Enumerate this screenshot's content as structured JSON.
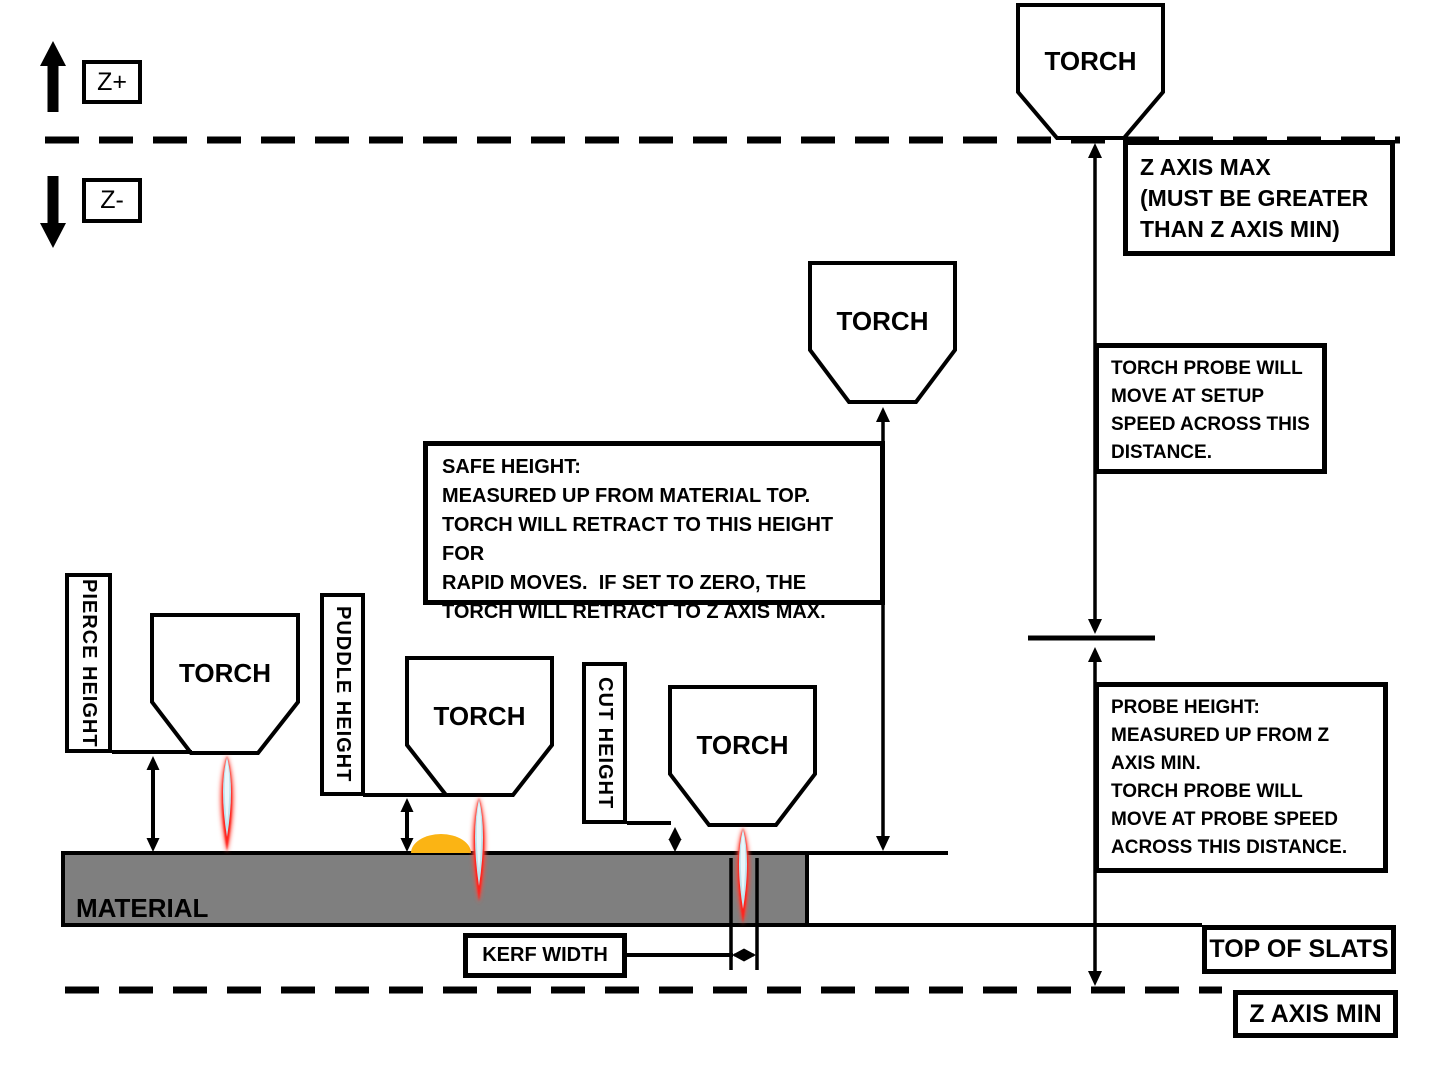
{
  "diagram": {
    "axis": {
      "z_plus": "Z+",
      "z_minus": "Z-"
    },
    "torches": [
      {
        "role": "torch-at-z-axis-max",
        "label": "TORCH"
      },
      {
        "role": "torch-at-safe-height",
        "label": "TORCH"
      },
      {
        "role": "torch-at-pierce-height",
        "label": "TORCH"
      },
      {
        "role": "torch-at-puddle-height",
        "label": "TORCH"
      },
      {
        "role": "torch-at-cut-height",
        "label": "TORCH"
      }
    ],
    "callouts": {
      "z_axis_max": "Z AXIS MAX\n(MUST BE GREATER\nTHAN Z AXIS MIN)",
      "setup_speed": "TORCH PROBE WILL\nMOVE AT SETUP\nSPEED ACROSS THIS\nDISTANCE.",
      "probe_height": "PROBE HEIGHT:\nMEASURED UP FROM Z\nAXIS MIN.\nTORCH PROBE WILL\nMOVE AT PROBE SPEED\nACROSS THIS DISTANCE.",
      "safe_height": "SAFE HEIGHT:\nMEASURED UP FROM MATERIAL TOP.\nTORCH WILL RETRACT TO THIS HEIGHT FOR\nRAPID MOVES.  IF SET TO ZERO, THE\nTORCH WILL RETRACT TO Z AXIS MAX.",
      "kerf_width": "KERF WIDTH",
      "top_of_slats": "TOP OF SLATS",
      "z_axis_min": "Z AXIS MIN"
    },
    "height_labels": {
      "pierce": "PIERCE HEIGHT",
      "puddle": "PUDDLE HEIGHT",
      "cut": "CUT HEIGHT"
    },
    "material_label": "MATERIAL",
    "icons": {
      "z_plus_arrow": "up-arrow",
      "z_minus_arrow": "down-arrow"
    },
    "colors": {
      "line": "#000000",
      "background": "#FFFFFF",
      "material_fill": "#7F7F7F",
      "puddle_fill": "#FBB414",
      "flame_outer_red": "#FF4A3C",
      "flame_red": "#FF241C",
      "flame_blue": "#BFE5EF",
      "flame_core": "#EAF7FB"
    }
  }
}
